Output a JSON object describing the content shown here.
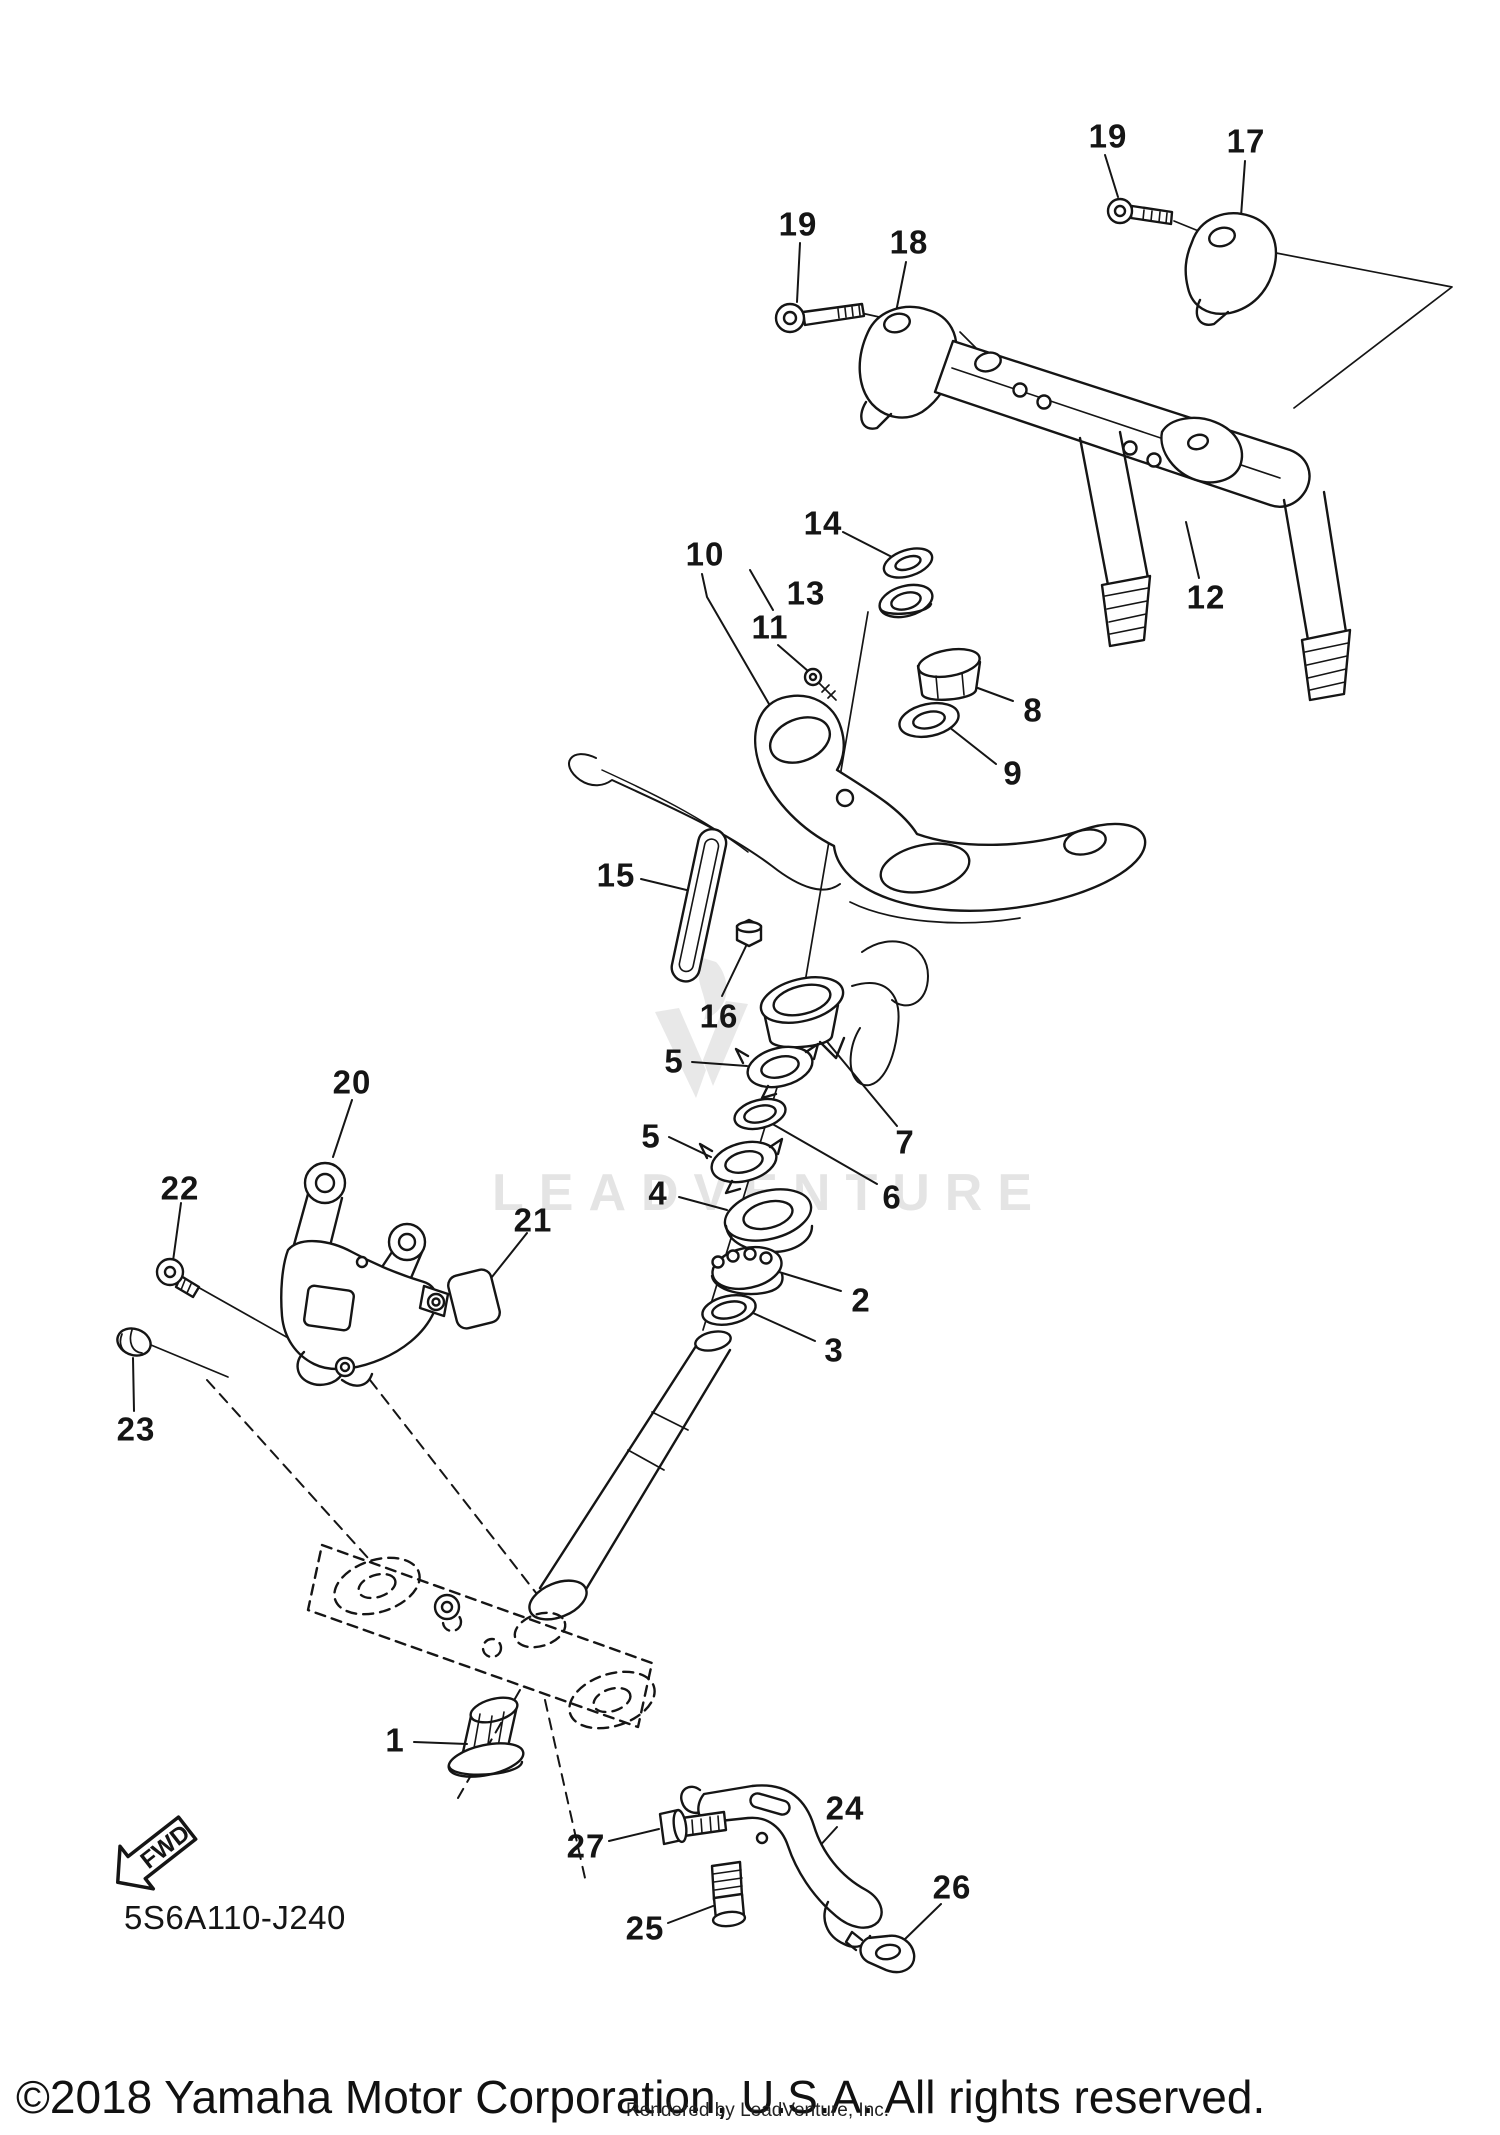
{
  "page": {
    "background": "#ffffff",
    "line_color": "#151515",
    "watermark_color": "#e4e4e4"
  },
  "watermark": {
    "text": "LEADVENTURE",
    "logo_icon": "leadventure-flame-icon"
  },
  "diagram": {
    "part_code": "5S6A110-J240",
    "fwd_label": "FWD",
    "callouts": [
      {
        "label": "19",
        "x": 798,
        "y": 224
      },
      {
        "label": "18",
        "x": 909,
        "y": 242
      },
      {
        "label": "19",
        "x": 1108,
        "y": 136
      },
      {
        "label": "17",
        "x": 1246,
        "y": 141
      },
      {
        "label": "14",
        "x": 823,
        "y": 523
      },
      {
        "label": "10",
        "x": 705,
        "y": 554
      },
      {
        "label": "13",
        "x": 806,
        "y": 593
      },
      {
        "label": "11",
        "x": 770,
        "y": 627
      },
      {
        "label": "12",
        "x": 1206,
        "y": 597
      },
      {
        "label": "8",
        "x": 1033,
        "y": 710
      },
      {
        "label": "9",
        "x": 1013,
        "y": 773
      },
      {
        "label": "15",
        "x": 616,
        "y": 875
      },
      {
        "label": "16",
        "x": 719,
        "y": 1016
      },
      {
        "label": "5",
        "x": 674,
        "y": 1061
      },
      {
        "label": "7",
        "x": 905,
        "y": 1142
      },
      {
        "label": "5",
        "x": 651,
        "y": 1136
      },
      {
        "label": "6",
        "x": 892,
        "y": 1197
      },
      {
        "label": "4",
        "x": 658,
        "y": 1193
      },
      {
        "label": "2",
        "x": 861,
        "y": 1300
      },
      {
        "label": "3",
        "x": 834,
        "y": 1350
      },
      {
        "label": "20",
        "x": 352,
        "y": 1082
      },
      {
        "label": "22",
        "x": 180,
        "y": 1188
      },
      {
        "label": "21",
        "x": 533,
        "y": 1220
      },
      {
        "label": "23",
        "x": 136,
        "y": 1429
      },
      {
        "label": "1",
        "x": 395,
        "y": 1740
      },
      {
        "label": "27",
        "x": 586,
        "y": 1846
      },
      {
        "label": "24",
        "x": 845,
        "y": 1808
      },
      {
        "label": "26",
        "x": 952,
        "y": 1887
      },
      {
        "label": "25",
        "x": 645,
        "y": 1928
      }
    ]
  },
  "footer": {
    "copyright": "©2018 Yamaha Motor Corporation, U.S.A. All rights reserved.",
    "rendered_by": "Rendered by LeadVenture, Inc."
  }
}
